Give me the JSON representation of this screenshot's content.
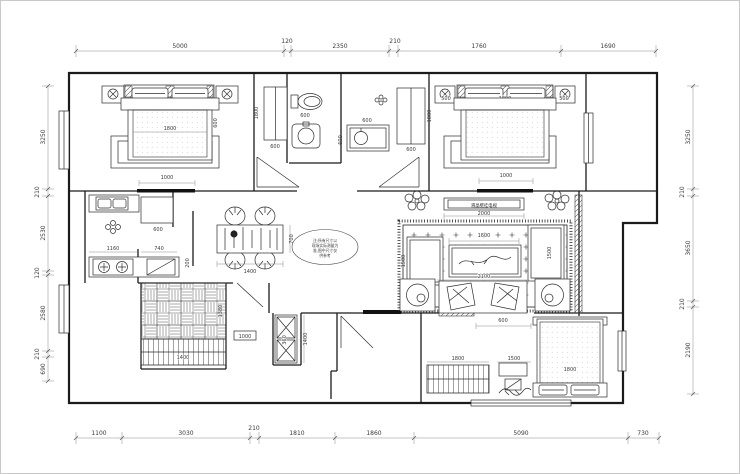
{
  "dims": {
    "top": [
      "5000",
      "120",
      "2350",
      "210",
      "1760",
      "1690"
    ],
    "bottom": [
      "1100",
      "3030",
      "210",
      "1810",
      "1860",
      "5090",
      "730"
    ],
    "left": [
      "3250",
      "210",
      "2530",
      "120",
      "2580",
      "210",
      "690"
    ],
    "right": [
      "3250",
      "210",
      "3650",
      "210",
      "2190"
    ]
  },
  "rooms": {
    "bedroom1": {
      "bed": "1800",
      "side": "600",
      "door": "1000"
    },
    "bath": {
      "ward_left": "600",
      "ward_left_h": "1800",
      "toilet": "600",
      "vanity_w": "600",
      "vanity_d": "600",
      "ward_right": "600",
      "ward_right_h": "1800"
    },
    "bedroom2": {
      "left": "500",
      "width": "1800",
      "right": "500",
      "door": "1000"
    },
    "kitchen": {
      "counter": "1160",
      "cabinet": "740",
      "fridge": "600",
      "depth": "200"
    },
    "dining": {
      "width": "1400",
      "depth": "700"
    },
    "living": {
      "tv_label": "液晶壁挂电视",
      "tv": "2000",
      "table": "1600",
      "sofa": "2100",
      "side_left": "1500",
      "side_right": "1500"
    },
    "cloak": {
      "tile": "1380",
      "wardrobe": "1400",
      "shelf": "1000",
      "cabinet": "360",
      "cabinet_h": "1400"
    },
    "entry": {
      "opening": "600"
    },
    "bedroom3": {
      "wardrobe": "1800",
      "desk": "1500",
      "bed": "1800"
    }
  },
  "note": {
    "l1": "注:所有尺寸以",
    "l2": "现场实际测量为",
    "l3": "准,图中尺寸仅",
    "l4": "供参考"
  }
}
